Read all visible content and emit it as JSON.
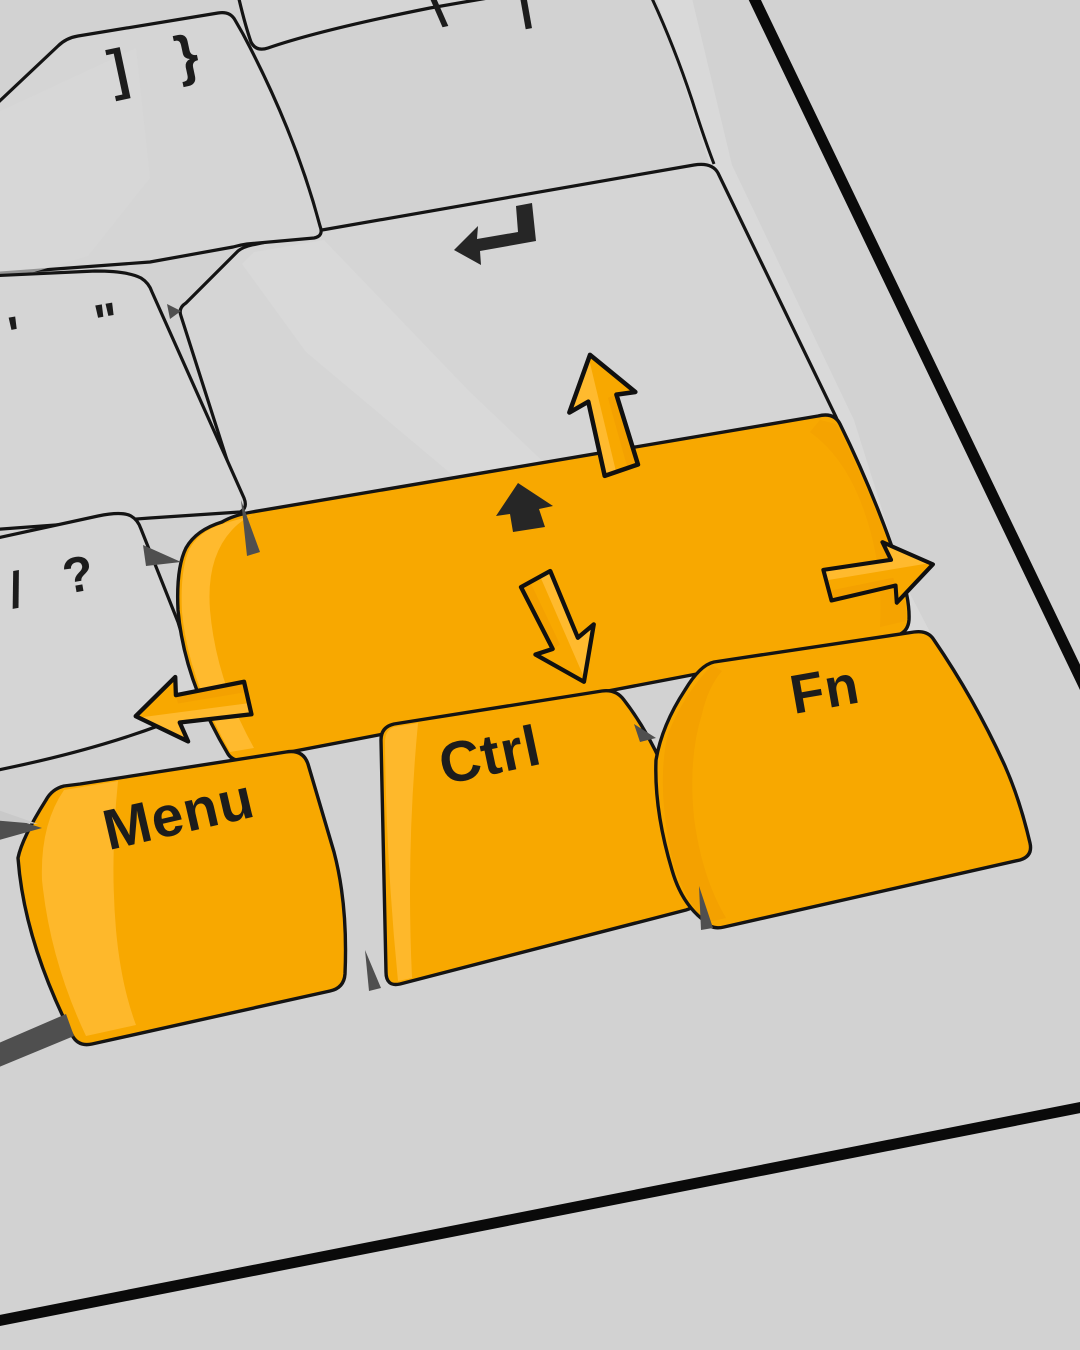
{
  "scene": {
    "description": "Stylized 3D illustration of the bottom-right corner of a keyboard, tilted about -12 degrees, with highlighted orange modifier keys and four 3D directional arrows",
    "background_color": "#d2d2d2"
  },
  "keyboard": {
    "colors": {
      "plate": "#d2d2d2",
      "key_gray": "#d5d5d5",
      "key_gray_light": "#dbdbdb",
      "key_orange": "#f8a800",
      "key_orange_light": "#ffbb33",
      "key_orange_dark": "#ef9a00",
      "outline": "#141414",
      "shadow_sliver": "#4f4f4f",
      "legend": "#1c1c1c",
      "case_edge": "#0a0a0a"
    },
    "legends": {
      "bracket": [
        "]",
        "}"
      ],
      "backslash": [
        "\\",
        "|"
      ],
      "quote": [
        "'",
        "\""
      ],
      "question": [
        "/",
        "?"
      ],
      "menu": "Menu",
      "ctrl": "Ctrl",
      "fn": "Fn",
      "enter_symbol": "return-arrow",
      "shift_symbol": "shift-arrow"
    },
    "keys": [
      {
        "id": "bracket-key",
        "legend": "] }",
        "color": "gray"
      },
      {
        "id": "backslash-key",
        "legend": "\\ |",
        "color": "gray",
        "note": "cut off by top edge"
      },
      {
        "id": "enter-key",
        "legend": "return-arrow glyph",
        "color": "gray"
      },
      {
        "id": "quote-key",
        "legend": "' \"",
        "color": "gray"
      },
      {
        "id": "question-key",
        "legend": "/ ?",
        "color": "gray"
      },
      {
        "id": "shift-key",
        "legend": "shift-arrow glyph",
        "color": "orange"
      },
      {
        "id": "menu-key",
        "legend": "Menu",
        "color": "orange"
      },
      {
        "id": "ctrl-key",
        "legend": "Ctrl",
        "color": "orange"
      },
      {
        "id": "fn-key",
        "legend": "Fn",
        "color": "orange"
      }
    ],
    "arrows": [
      {
        "id": "arrow-up",
        "direction": "up",
        "color": "#f8a800"
      },
      {
        "id": "arrow-down",
        "direction": "down",
        "color": "#f8a800"
      },
      {
        "id": "arrow-left",
        "direction": "left",
        "color": "#f8a800"
      },
      {
        "id": "arrow-right",
        "direction": "right",
        "color": "#f8a800"
      }
    ]
  }
}
